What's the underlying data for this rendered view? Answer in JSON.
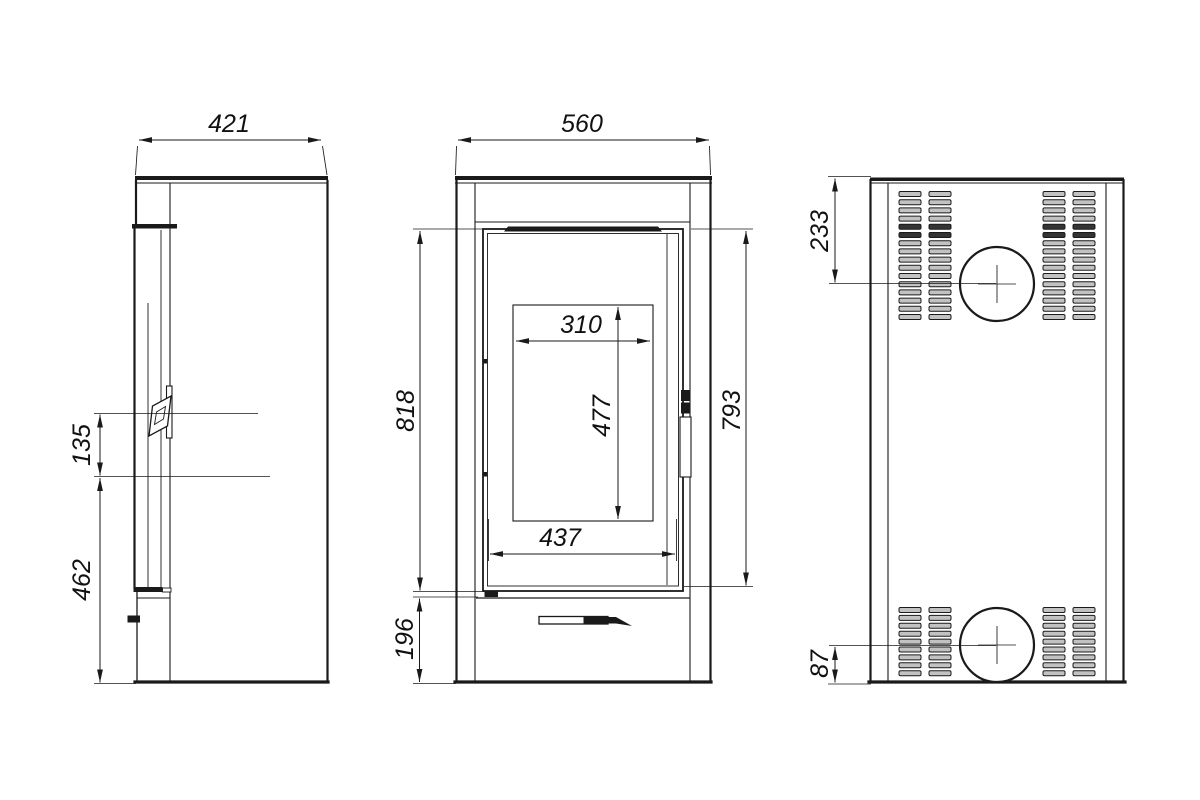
{
  "dimensions_mm": {
    "side_view": {
      "top_width": "421",
      "handle_height": "135",
      "handle_to_floor": "462"
    },
    "front_view": {
      "top_width": "560",
      "body_height": "818",
      "door_height": "793",
      "glass_width": "310",
      "glass_height": "477",
      "door_width": "437",
      "base_height": "196"
    },
    "back_view": {
      "flue_top_offset": "233",
      "flue_bottom_offset": "87"
    }
  },
  "colors": {
    "line": "#1a1a1a",
    "vent_slat_fill": "#c2c2c2",
    "background": "#ffffff"
  }
}
